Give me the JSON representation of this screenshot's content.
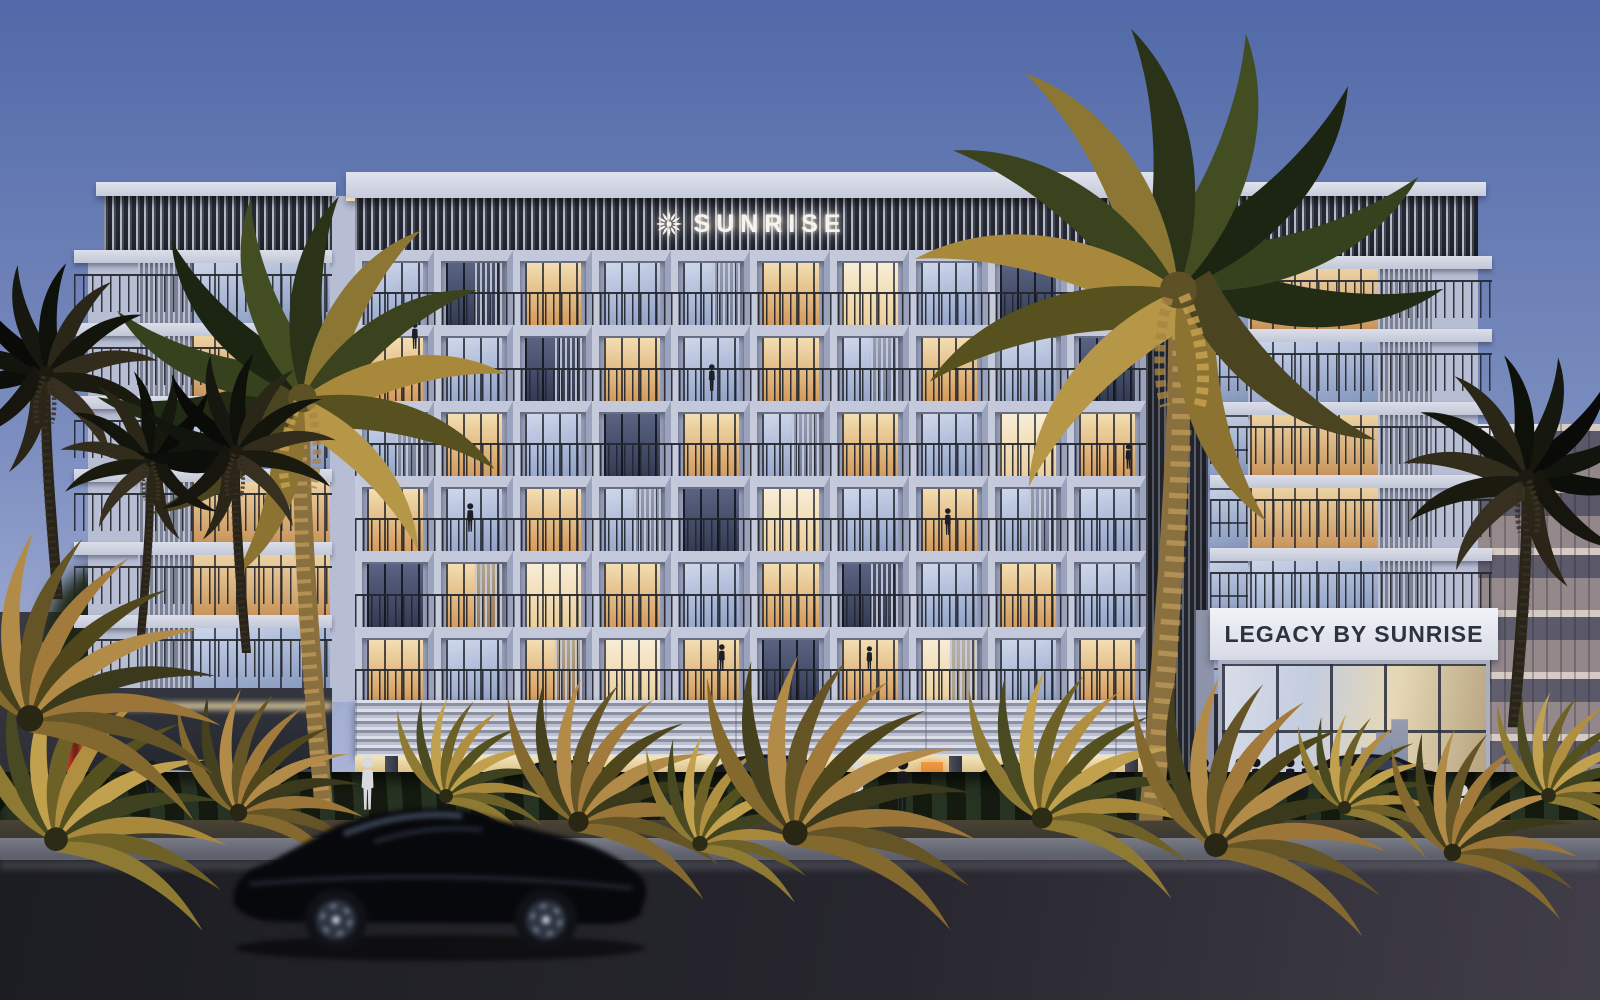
{
  "scene": {
    "description": "Dusk architectural rendering of the Legacy by Sunrise residential building with palm-lined street, parked cars and a motion-blurred sedan passing in the foreground",
    "time_of_day": "dusk"
  },
  "branding": {
    "logo_text": "SUNRISE",
    "logo_icon": "sun-burst-icon",
    "entrance_sign": "LEGACY BY SUNRISE"
  },
  "palette": {
    "sky_top": "#5169a8",
    "sky_mid": "#7d8fc0",
    "sky_low": "#a3aed4",
    "sky_horizon": "#bfc4dd",
    "facade": "#b7bdd3",
    "facade_shade": "#9aa1bb",
    "louver_light": "#b6bac9",
    "rail": "#23262d",
    "win_warm_1": "#f3deb2",
    "win_warm_2": "#d39b5c",
    "win_cool_1": "#cfd8eb",
    "win_cool_2": "#8fa0c6",
    "win_dark_1": "#5a6382",
    "win_dark_2": "#333b54",
    "win_bright_1": "#f8edd6",
    "win_bright_2": "#eccf9c",
    "sign_text": "#2e3340",
    "gold_foliage": "#b3954a",
    "neon_red": "#d13a24"
  },
  "building": {
    "central": {
      "rows": 6,
      "cols": 10,
      "windows": [
        [
          "cool",
          "dark",
          "warm",
          "cool",
          "cool",
          "warm",
          "bright",
          "cool",
          "dark",
          "cool"
        ],
        [
          "warm",
          "cool",
          "dark",
          "warm",
          "cool",
          "warm",
          "cool",
          "warm",
          "cool",
          "dark"
        ],
        [
          "cool",
          "warm",
          "cool",
          "dark",
          "warm",
          "cool",
          "warm",
          "cool",
          "bright",
          "warm"
        ],
        [
          "warm",
          "cool",
          "warm",
          "cool",
          "dark",
          "bright",
          "cool",
          "warm",
          "cool",
          "cool"
        ],
        [
          "dark",
          "warm",
          "bright",
          "warm",
          "cool",
          "warm",
          "dark",
          "cool",
          "warm",
          "cool"
        ],
        [
          "warm",
          "cool",
          "warm",
          "bright",
          "warm",
          "dark",
          "warm",
          "bright",
          "cool",
          "warm"
        ]
      ],
      "louver_cells": [
        [
          0,
          1
        ],
        [
          0,
          4
        ],
        [
          1,
          2
        ],
        [
          1,
          6
        ],
        [
          2,
          0
        ],
        [
          2,
          5
        ],
        [
          3,
          3
        ],
        [
          3,
          8
        ],
        [
          4,
          1
        ],
        [
          4,
          6
        ],
        [
          5,
          2
        ],
        [
          5,
          7
        ]
      ]
    },
    "left_tower": {
      "floors": [
        "cool",
        "warm",
        "cool",
        "warm",
        "warm",
        "cool"
      ]
    },
    "right_tower": {
      "floors": [
        "warm",
        "cool",
        "warm",
        "warm",
        "cool",
        "warm"
      ]
    }
  },
  "street": {
    "parked_cars": [
      {
        "x": 118,
        "y": 806,
        "w": 118,
        "tone": "silver"
      },
      {
        "x": 236,
        "y": 804,
        "w": 126,
        "tone": "dark"
      },
      {
        "x": 492,
        "y": 806,
        "w": 152,
        "tone": "dark"
      },
      {
        "x": 682,
        "y": 808,
        "w": 178,
        "tone": "dark"
      },
      {
        "x": 952,
        "y": 806,
        "w": 140,
        "tone": "dark"
      },
      {
        "x": 1282,
        "y": 806,
        "w": 172,
        "tone": "dark"
      }
    ],
    "pedestrians": [
      {
        "x": 368,
        "y": 812,
        "h": 56,
        "tone": "light"
      },
      {
        "x": 152,
        "y": 806,
        "h": 46,
        "tone": "dark"
      },
      {
        "x": 858,
        "y": 812,
        "h": 52,
        "tone": "light"
      },
      {
        "x": 903,
        "y": 814,
        "h": 56,
        "tone": "dark"
      },
      {
        "x": 1204,
        "y": 806,
        "h": 48,
        "tone": "dark"
      },
      {
        "x": 1240,
        "y": 800,
        "h": 42,
        "tone": "dark"
      },
      {
        "x": 1256,
        "y": 802,
        "h": 44,
        "tone": "dark"
      },
      {
        "x": 1272,
        "y": 800,
        "h": 40,
        "tone": "dark"
      },
      {
        "x": 1290,
        "y": 802,
        "h": 44,
        "tone": "dark"
      },
      {
        "x": 1306,
        "y": 800,
        "h": 42,
        "tone": "dark"
      },
      {
        "x": 1352,
        "y": 810,
        "h": 54,
        "tone": "dark"
      },
      {
        "x": 1462,
        "y": 842,
        "h": 58,
        "tone": "light"
      }
    ],
    "balcony_people": [
      {
        "x": 470,
        "y": 533,
        "h": 30
      },
      {
        "x": 712,
        "y": 392,
        "h": 28
      },
      {
        "x": 948,
        "y": 536,
        "h": 28
      },
      {
        "x": 722,
        "y": 672,
        "h": 28
      },
      {
        "x": 869,
        "y": 672,
        "h": 26
      },
      {
        "x": 180,
        "y": 455,
        "h": 26
      },
      {
        "x": 415,
        "y": 350,
        "h": 28
      },
      {
        "x": 1128,
        "y": 470,
        "h": 26
      }
    ]
  },
  "vegetation": {
    "tall_palms": [
      {
        "x": 302,
        "y": 806,
        "s": 1.02,
        "flip": false,
        "dark": false
      },
      {
        "x": 1178,
        "y": 818,
        "s": 1.32,
        "flip": true,
        "dark": false
      },
      {
        "x": 46,
        "y": 598,
        "s": 0.56,
        "flip": false,
        "dark": true
      },
      {
        "x": 150,
        "y": 640,
        "s": 0.45,
        "flip": true,
        "dark": true
      },
      {
        "x": 236,
        "y": 652,
        "s": 0.5,
        "flip": false,
        "dark": true
      },
      {
        "x": 1526,
        "y": 726,
        "s": 0.62,
        "flip": true,
        "dark": true
      }
    ],
    "ferns": [
      {
        "x": 56,
        "y": 846,
        "s": 1.7
      },
      {
        "x": 238,
        "y": 818,
        "s": 1.25
      },
      {
        "x": 446,
        "y": 800,
        "s": 1.0
      },
      {
        "x": 578,
        "y": 828,
        "s": 1.45
      },
      {
        "x": 700,
        "y": 848,
        "s": 1.1
      },
      {
        "x": 795,
        "y": 840,
        "s": 1.8
      },
      {
        "x": 1042,
        "y": 824,
        "s": 1.5
      },
      {
        "x": 1216,
        "y": 852,
        "s": 1.7
      },
      {
        "x": 1344,
        "y": 812,
        "s": 0.95
      },
      {
        "x": 1452,
        "y": 858,
        "s": 1.25
      },
      {
        "x": 1548,
        "y": 800,
        "s": 1.05
      },
      {
        "x": 30,
        "y": 726,
        "s": 1.9
      }
    ]
  }
}
